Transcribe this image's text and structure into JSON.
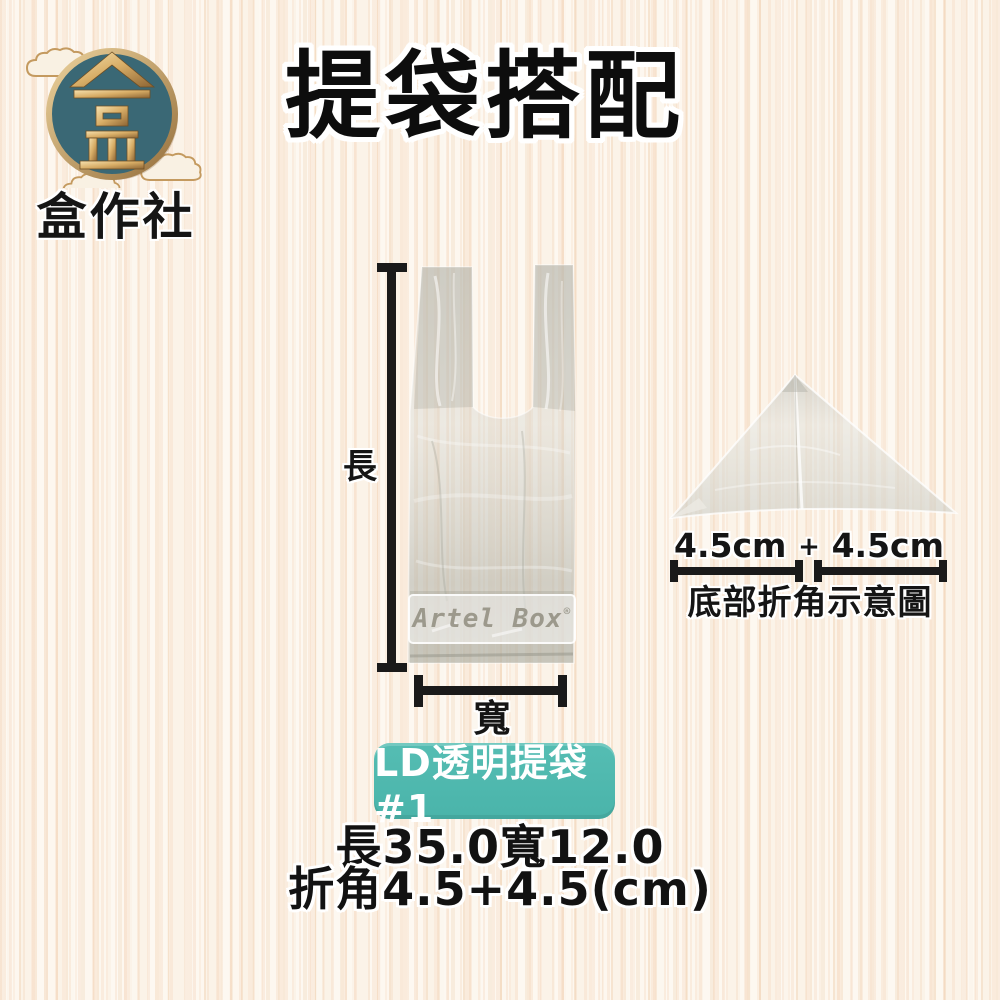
{
  "brand": {
    "name": "盒作社",
    "logo_glyph": "盒"
  },
  "title": "提袋搭配",
  "bag_diagram": {
    "length_label": "長",
    "width_label": "寬",
    "watermark": "Artel Box",
    "watermark_mark": "®"
  },
  "corner_diagram": {
    "left_measure": "4.5cm",
    "plus": "+",
    "right_measure": "4.5cm",
    "caption": "底部折角示意圖"
  },
  "product": {
    "badge": "LD透明提袋#1",
    "spec_line1": "長35.0寬12.0",
    "spec_line2": "折角4.5+4.5(cm)"
  },
  "colors": {
    "badge_teal": "#4bb8ad",
    "logo_teal": "#3a6875",
    "gold": "#c49a5f",
    "dimension_black": "#1a1a1a",
    "wood_base": "#fbf3e8"
  }
}
